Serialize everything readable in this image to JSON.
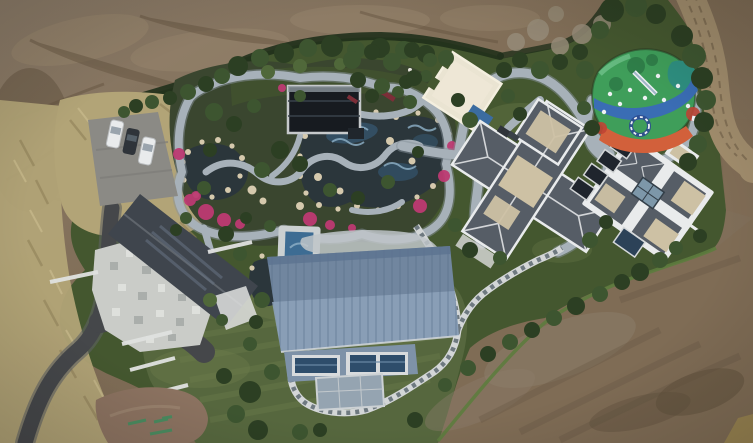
{
  "meta": {
    "title": "Aerial drone photograph of a landscaped estate compound surrounded by bare earth",
    "width_px": 753,
    "height_px": 443
  },
  "palette": {
    "dirt_base": "#7f6c55",
    "dirt_light": "#99876e",
    "dirt_dark": "#60503c",
    "dirt_gray": "#8c7d6b",
    "dirt_road": "#a08c6c",
    "road_track": "#73624a",
    "grass_dry": "#b2a477",
    "grass_dry_dark": "#8f8158",
    "grass_dry_light": "#c9bb8d",
    "green_base": "#44572f",
    "green_dark2": "#2c3f23",
    "green_tree": "#3d5530",
    "green_tree2": "#50683a",
    "tree_bare": "#958b78",
    "lawn": "#56673e",
    "lawn_light": "#6d7e4c",
    "hedge": "#20301b",
    "hedge_bright": "#5d7c3e",
    "asphalt": "#45474a",
    "asphalt_edge": "#5e6163",
    "pad_gray": "#8b8a85",
    "car_white": "#e9ebec",
    "car_dark": "#2f343a",
    "courtyard": "#caccc8",
    "courtyard_dark": "#a3a7a4",
    "courtyard_light": "#e3e5e2",
    "roof_house": "#3f454d",
    "roof_glass": "#64707f",
    "wall_white": "#e0e2e0",
    "path_gray": "#a7b1b9",
    "path_edge": "#87929b",
    "paver_light": "#d3d6d7",
    "paver_dark": "#6e7980",
    "pond": "#2b363b",
    "pool_blue": "#3d6c93",
    "pool_light": "#8fb2c9",
    "rock": "#d5c9ad",
    "flower": "#bd3a72",
    "flower_dark": "#7c2e38",
    "bed_green": "#3a462f",
    "pavilion": "#171b20",
    "pavilion_frame": "#c6c9cb",
    "pad_cream": "#eae4d2",
    "pad_cream2": "#f4efdf",
    "tarp": "#3b6ca0",
    "barn_top": "#71869f",
    "barn_bottom": "#8ca1b8",
    "barn_seam": "#5a708c",
    "barn_wall": "#7e92a8",
    "win_frame": "#d8dbdd",
    "win_glass": "#2e4d6b",
    "glass_roof": "#95a4b1",
    "villa_roof": "#565d66",
    "villa_trim": "#e9ebec",
    "villa_beige": "#cdc1a4",
    "skylight": "#7d97a9",
    "panel_dark": "#1f252d",
    "play_green": "#3f9e5a",
    "play_green_dark": "#2f7f49",
    "play_blue": "#3a6db4",
    "play_teal": "#2e8f80",
    "play_orange": "#d2603b",
    "play_red": "#bf4434",
    "play_white": "#eef1f4",
    "play_navy": "#2b4a8f",
    "white_dot": "#e8e6df"
  },
  "scene": {
    "objects": [
      {
        "name": "bare-earth",
        "description": "Graded brown dirt surrounding the estate on the top, right and bottom"
      },
      {
        "name": "estate-grounds",
        "description": "Green landscaped compound with hedge border"
      },
      {
        "name": "parking-area",
        "description": "Concrete pad with two white cars and one dark car"
      },
      {
        "name": "driveway",
        "description": "Dark asphalt drive winding from bottom-left corner"
      },
      {
        "name": "west-house",
        "description": "House with dark gabled glass roof and white stone courtyard"
      },
      {
        "name": "water-garden",
        "description": "Ornamental garden with ponds, rock edges, pink flowers and winding stone paths"
      },
      {
        "name": "garden-pavilion",
        "description": "Dark flat glass-roofed pavilion in the garden"
      },
      {
        "name": "event-pad",
        "description": "Cream colored flat pad / court"
      },
      {
        "name": "playground",
        "description": "Colorful rubber-surface playground with slide and equipment"
      },
      {
        "name": "central-villa",
        "description": "Cross-shaped villa with slate hip roofs and beige flat decks"
      },
      {
        "name": "right-villa",
        "description": "Villa with white-trimmed pod roofs, skylight and dark solar panels"
      },
      {
        "name": "barn",
        "description": "Large blue standing-seam metal roof building with glazed lower level"
      },
      {
        "name": "lap-pool",
        "description": "Small blue pool with light deck"
      },
      {
        "name": "path-network",
        "description": "Smooth gray walking paths looping through the grounds"
      },
      {
        "name": "paver-path",
        "description": "Checkered stone paver path wrapping the barn and climbing northeast"
      },
      {
        "name": "dirt-road",
        "description": "Light dirt road curving along the top-right corner"
      },
      {
        "name": "lawn",
        "description": "Olive green mowed lawn at bottom-center"
      },
      {
        "name": "paint-marks",
        "description": "Green survey paint marks on the bottom-left dirt patch"
      }
    ]
  }
}
